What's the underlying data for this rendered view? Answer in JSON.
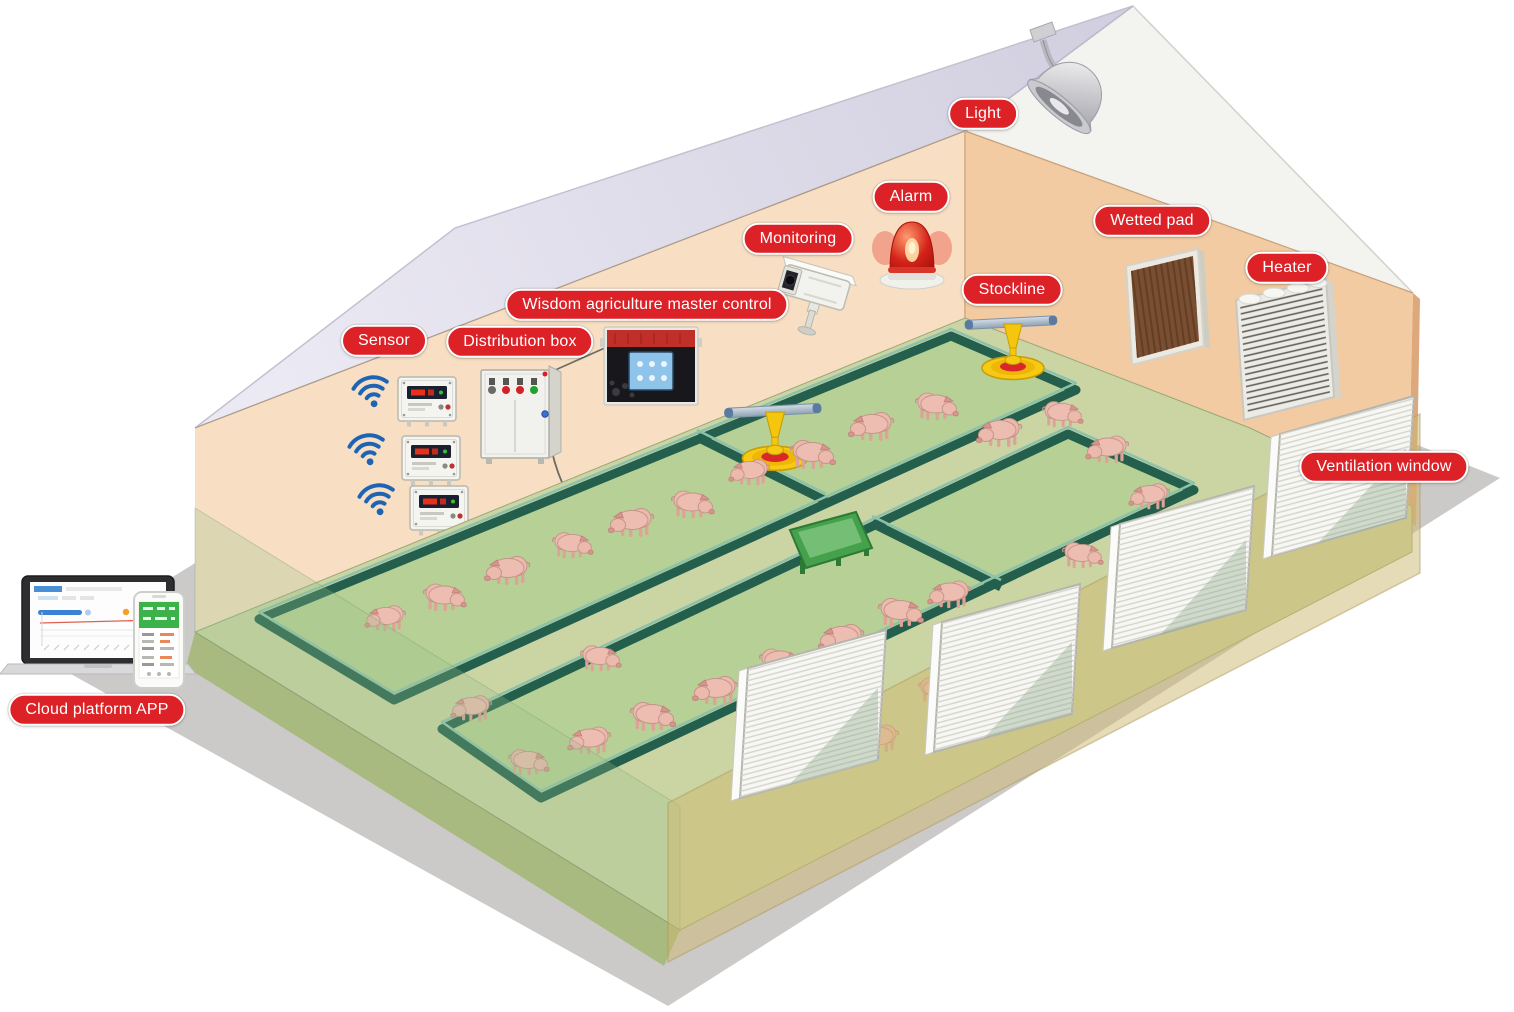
{
  "labels": {
    "light": "Light",
    "alarm": "Alarm",
    "monitoring": "Monitoring",
    "master_control": "Wisdom agriculture master control",
    "wetted_pad": "Wetted pad",
    "heater": "Heater",
    "stockline": "Stockline",
    "sensor": "Sensor",
    "distribution_box": "Distribution box",
    "ventilation_window": "Ventilation window",
    "cloud_platform_app": "Cloud platform APP"
  },
  "icons": {
    "wifi-icon": "wireless sensor signal arcs",
    "camera-icon": "CCTV surveillance camera",
    "siren-icon": "red alarm beacon",
    "lamp-icon": "industrial ceiling lamp",
    "feeder-icon": "yellow stockline feeder pan",
    "laptop-icon": "cloud platform dashboard laptop",
    "phone-icon": "cloud platform mobile app",
    "pig-icon": "pig livestock figure"
  },
  "colors": {
    "label_bg": "#dc2127",
    "label_text": "#ffffff",
    "roof_inner": "#d8d5e4",
    "roof_outer": "#f3f3f0",
    "wall_left": "#f8dfc3",
    "wall_right": "#f2cba2",
    "floor": "#cbd5a3",
    "pen_fill": "#b7d095",
    "pen_wall": "#235f4c",
    "shadow": "#cbcac8",
    "pig": "#ecb9ad",
    "wifi_blue": "#1d64b5",
    "feeder_yellow": "#f6ca12",
    "alarm_red": "#d42318",
    "phone_green": "#3cb24a"
  }
}
